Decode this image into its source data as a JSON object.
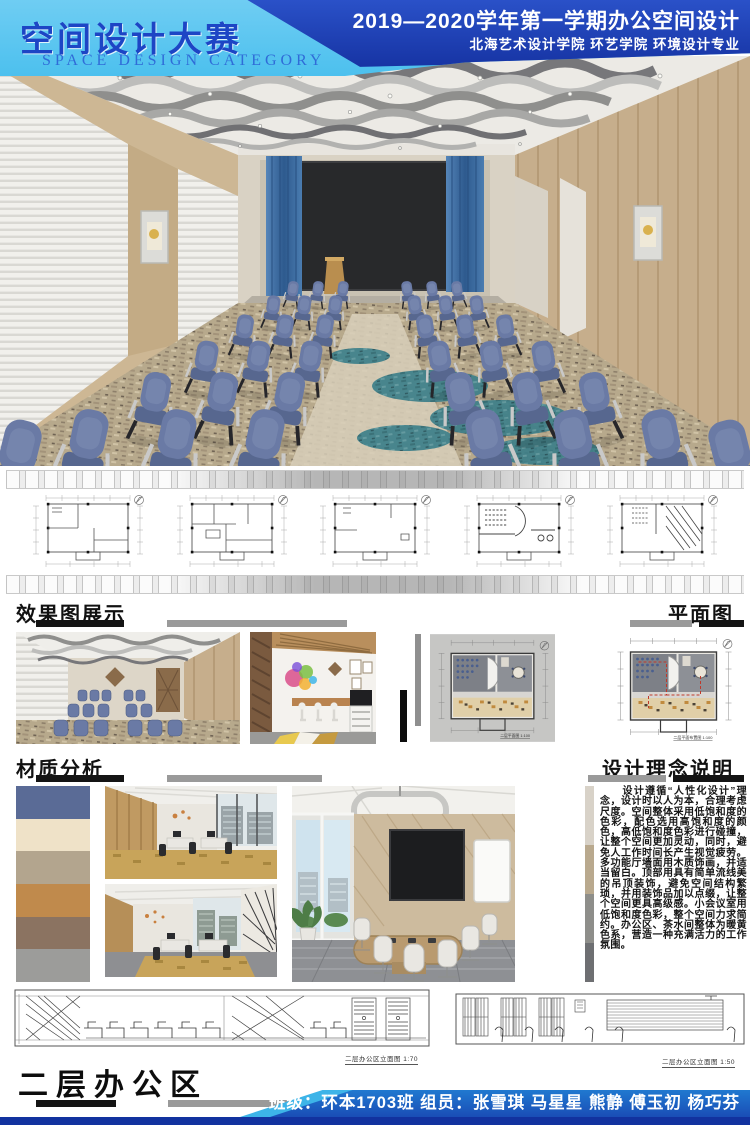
{
  "header": {
    "title_cn": "空间设计大赛",
    "title_en": "SPACE DESIGN CATEGORY",
    "term_line": "2019—2020学年第一学期办公空间设计",
    "school_line": "北海艺术设计学院  环艺学院  环境设计专业"
  },
  "sections": {
    "effects_title": "效果图展示",
    "plan_title": "平面图",
    "materials_title": "材质分析",
    "concept_title": "设计理念说明"
  },
  "concept_text": "　　设计遵循“人性化设计”理念，设计时以人为本，合理考虑尺度。空间整体采用低饱和度的色彩，配色选用高饱和度的颜色，高低饱和度色彩进行碰撞，让整个空间更加灵动，同时，避免人工作时间长产生视觉疲劳。多功能厅墙面用木质饰画，并适当留白。顶部用具有简单流线美的吊顶装饰，避免空间结构繁琐，并用装饰品加以点缀，让整个空间更具高级感。小会议室用低饱和度色彩，整个空间力求简约。办公区、茶水间整体为暖黄色系，营造一种充满活力的工作氛围。",
  "captions": {
    "plan_color_1": "二层平面图  1:100",
    "plan_color_2": "二层平面布置图  1:100",
    "elevation_left": "二层办公区立面图  1:70",
    "elevation_right": "二层办公区立面图  1:50"
  },
  "footer": {
    "area_title": "二层办公区",
    "credit_line": "班级：环本1703班    组员：张雪琪  马星星  熊静  傅玉初  杨巧芬"
  },
  "materials": {
    "swatches": [
      {
        "name": "blue-leather",
        "color": "#5a6b96"
      },
      {
        "name": "cream-texture",
        "color": "#efe2c8"
      },
      {
        "name": "greige-wood",
        "color": "#b3a58e"
      },
      {
        "name": "oak-wood",
        "color": "#c08a4c"
      },
      {
        "name": "walnut-wood",
        "color": "#8b7361"
      },
      {
        "name": "gray-marble",
        "color": "#9c9c9a"
      }
    ]
  },
  "colors": {
    "header_dark_blue": "#1b3cb2",
    "header_light_blue": "#57c5f0",
    "title_blue": "#1d45c5",
    "footer_blue": "#1e63c0",
    "accent_cyan": "#3db4e8",
    "bar_black": "#141414",
    "bar_gray": "#9a9a9a",
    "chair_blue": "#6a7aa5",
    "curtain_blue": "#3f6fa3",
    "carpet_tan": "#b7a98c",
    "carpet_teal": "#3a7e89"
  }
}
